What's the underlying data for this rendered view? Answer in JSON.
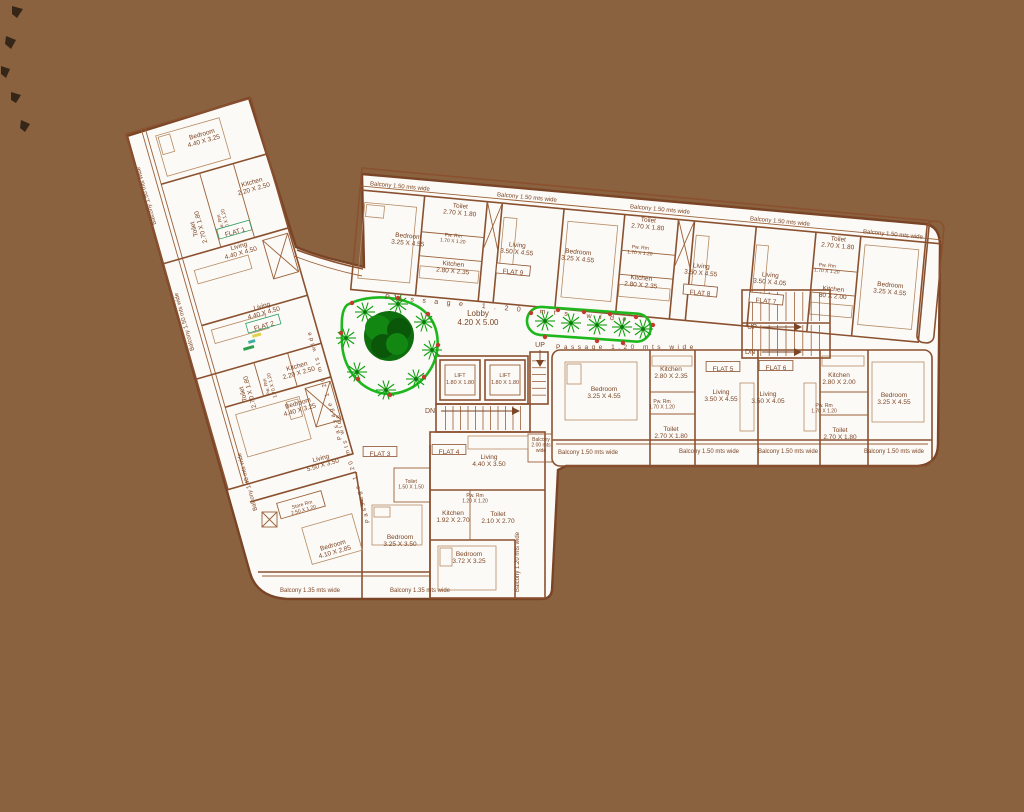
{
  "colors": {
    "background": "#8a6240",
    "plan_paper": "#fcfaf6",
    "wall_line": "#8a5130",
    "text": "#7c4526",
    "planter_green": "#1eb81e",
    "tree_dark_green": "#0c6e0c",
    "planter_dot_red": "#c23b2e",
    "flat_label_green": "#2d9e63"
  },
  "plan": {
    "lobby": {
      "name": "Lobby",
      "dims": "4.20 X 5.00"
    },
    "passage_label": "Passage 1.20 mts wide",
    "lift_label": "LIFT 1.80 X 1.80",
    "stairs": {
      "up": "UP",
      "down": "DN"
    },
    "flats": [
      "FLAT 1",
      "FLAT 2",
      "FLAT 3",
      "FLAT 4",
      "FLAT 5",
      "FLAT 6",
      "FLAT 7",
      "FLAT 8",
      "FLAT 9"
    ],
    "icons": [
      "palm-tree-icon",
      "shade-tree-icon",
      "staircase-icon",
      "planter-bed-icon"
    ]
  },
  "labels": [
    {
      "id": "wing-balcony-1",
      "c": "balc",
      "x": 146,
      "y": 196,
      "r": -106,
      "t": [
        "Balcony 1.50 mts wide"
      ]
    },
    {
      "id": "wing-balcony-2",
      "c": "balc",
      "x": 184,
      "y": 322,
      "r": -106,
      "t": [
        "Balcony 1.50 mts wide"
      ]
    },
    {
      "id": "bedroom-f1",
      "x": 203,
      "y": 138,
      "r": -16,
      "t": [
        "Bedroom",
        "4.40 X 3.25"
      ]
    },
    {
      "id": "toilet-f1",
      "x": 198,
      "y": 228,
      "r": -106,
      "t": [
        "Toilet",
        "2.70 X 1.80"
      ]
    },
    {
      "id": "pwrm-f1",
      "c": "tiny",
      "x": 224,
      "y": 222,
      "r": -106,
      "t": [
        "Pw. Rm",
        "1.70 X 1.20"
      ]
    },
    {
      "id": "kitchen-f1",
      "x": 253,
      "y": 186,
      "r": -16,
      "t": [
        "Kitchen",
        "2.20 X 2.50"
      ]
    },
    {
      "id": "flat1",
      "c": "flatg",
      "x": 235,
      "y": 232,
      "r": -16,
      "t": [
        "FLAT 1"
      ]
    },
    {
      "id": "living-f1",
      "x": 240,
      "y": 250,
      "r": -16,
      "t": [
        "Living",
        "4.40 X 4.50"
      ]
    },
    {
      "id": "living-f2",
      "x": 263,
      "y": 310,
      "r": -16,
      "t": [
        "Living",
        "4.40 X 4.50"
      ]
    },
    {
      "id": "flat2",
      "c": "flatg",
      "x": 264,
      "y": 326,
      "r": -16,
      "t": [
        "FLAT 2"
      ]
    },
    {
      "id": "toilet-f2",
      "x": 247,
      "y": 393,
      "r": -106,
      "t": [
        "Toilet",
        "2.70 X 1.80"
      ]
    },
    {
      "id": "pwrm-f2",
      "c": "tiny",
      "x": 270,
      "y": 386,
      "r": -106,
      "t": [
        "Pw. Rm",
        "1.70 X 1.20"
      ]
    },
    {
      "id": "kitchen-f2",
      "x": 298,
      "y": 370,
      "r": -16,
      "t": [
        "Kitchen",
        "2.20 X 2.50"
      ]
    },
    {
      "id": "bedroom-f2",
      "x": 299,
      "y": 407,
      "r": -16,
      "t": [
        "Bedroom",
        "4.40 X 3.25"
      ]
    },
    {
      "id": "living-f3",
      "x": 322,
      "y": 462,
      "r": -16,
      "t": [
        "Living",
        "5.50 X 3.50"
      ]
    },
    {
      "id": "flat3",
      "c": "flat",
      "x": 380,
      "y": 454,
      "t": [
        "FLAT 3"
      ]
    },
    {
      "id": "store-rm",
      "c": "tiny",
      "x": 303,
      "y": 508,
      "r": -16,
      "t": [
        "Store Rm",
        "2.50 X 1.20"
      ]
    },
    {
      "id": "bedroom-f3a",
      "x": 334,
      "y": 549,
      "r": -16,
      "t": [
        "Bedroom",
        "4.10 X 2.85"
      ]
    },
    {
      "id": "bedroom-f3b",
      "x": 400,
      "y": 541,
      "t": [
        "Bedroom",
        "3.25 X 3.50"
      ]
    },
    {
      "id": "balcony-left-low",
      "c": "balc",
      "x": 247,
      "y": 482,
      "r": -106,
      "t": [
        "Balcony 1.40 mts wide"
      ]
    },
    {
      "id": "balcony-bottom-1",
      "c": "balc",
      "x": 310,
      "y": 590,
      "t": [
        "Balcony 1.35 mts wide"
      ]
    },
    {
      "id": "balcony-bottom-2",
      "c": "balc",
      "x": 420,
      "y": 590,
      "t": [
        "Balcony 1.35 mts wide"
      ]
    },
    {
      "id": "toilet-small",
      "c": "tiny",
      "x": 411,
      "y": 485,
      "t": [
        "Toilet",
        "1.50 X 1.50"
      ]
    },
    {
      "id": "tb-balcony-1",
      "c": "balc",
      "x": 400,
      "y": 186,
      "r": 5.3,
      "t": [
        "Balcony 1.50 mts wide"
      ]
    },
    {
      "id": "tb-balcony-2",
      "c": "balc",
      "x": 527,
      "y": 197,
      "r": 5.3,
      "t": [
        "Balcony 1.50 mts wide"
      ]
    },
    {
      "id": "tb-balcony-3",
      "c": "balc",
      "x": 660,
      "y": 209,
      "r": 5.3,
      "t": [
        "Balcony 1.50 mts wide"
      ]
    },
    {
      "id": "tb-balcony-4",
      "c": "balc",
      "x": 780,
      "y": 221,
      "r": 5.3,
      "t": [
        "Balcony 1.50 mts wide"
      ]
    },
    {
      "id": "tb-balcony-5",
      "c": "balc",
      "x": 893,
      "y": 234,
      "r": 5.3,
      "t": [
        "Balcony 1.50 mts wide"
      ]
    },
    {
      "id": "bedroom-f9",
      "x": 408,
      "y": 240,
      "r": 5.3,
      "t": [
        "Bedroom",
        "3.25 X 4.55"
      ]
    },
    {
      "id": "toilet-f9",
      "x": 460,
      "y": 210,
      "r": 5.3,
      "t": [
        "Toilet",
        "2.70 X 1.80"
      ]
    },
    {
      "id": "pwrm-f9",
      "c": "tiny",
      "x": 453,
      "y": 239,
      "r": 5.3,
      "t": [
        "Pw. Rm",
        "1.70 X 1.20"
      ]
    },
    {
      "id": "kitchen-f9",
      "x": 453,
      "y": 268,
      "r": 5.3,
      "t": [
        "Kitchen",
        "2.80 X 2.35"
      ]
    },
    {
      "id": "living-f9",
      "x": 517,
      "y": 249,
      "r": 5.3,
      "t": [
        "Living",
        "3.50 X 4.55"
      ]
    },
    {
      "id": "flat9",
      "c": "flat",
      "x": 513,
      "y": 272,
      "r": 5.3,
      "t": [
        "FLAT 9"
      ]
    },
    {
      "id": "bedroom-f8",
      "x": 578,
      "y": 256,
      "r": 5.3,
      "t": [
        "Bedroom",
        "3.25 X 4.55"
      ]
    },
    {
      "id": "toilet-f8",
      "x": 648,
      "y": 224,
      "r": 5.3,
      "t": [
        "Toilet",
        "2.70 X 1.80"
      ]
    },
    {
      "id": "pwrm-f8",
      "c": "tiny",
      "x": 640,
      "y": 251,
      "r": 5.3,
      "t": [
        "Pw. Rm",
        "1.70 X 1.20"
      ]
    },
    {
      "id": "kitchen-f8",
      "x": 641,
      "y": 282,
      "r": 5.3,
      "t": [
        "Kitchen",
        "2.80 X 2.35"
      ]
    },
    {
      "id": "living-f8",
      "x": 701,
      "y": 270,
      "r": 5.3,
      "t": [
        "Living",
        "3.50 X 4.55"
      ]
    },
    {
      "id": "flat8",
      "c": "flat",
      "x": 700,
      "y": 293,
      "r": 5.3,
      "t": [
        "FLAT 8"
      ]
    },
    {
      "id": "living-f7",
      "x": 770,
      "y": 279,
      "r": 5.3,
      "t": [
        "Living",
        "3.50 X 4.05"
      ]
    },
    {
      "id": "flat7",
      "c": "flat",
      "x": 766,
      "y": 301,
      "r": 5.3,
      "t": [
        "FLAT 7"
      ]
    },
    {
      "id": "toilet-f7",
      "x": 838,
      "y": 243,
      "r": 5.3,
      "t": [
        "Toilet",
        "2.70 X 1.80"
      ]
    },
    {
      "id": "pwrm-f7",
      "c": "tiny",
      "x": 827,
      "y": 269,
      "r": 5.3,
      "t": [
        "Pw. Rm",
        "1.70 X 1.20"
      ]
    },
    {
      "id": "kitchen-f7",
      "x": 833,
      "y": 293,
      "r": 5.3,
      "t": [
        "Kitchen",
        "80 X 2.00"
      ]
    },
    {
      "id": "bedroom-f7",
      "x": 890,
      "y": 289,
      "r": 5.3,
      "t": [
        "Bedroom",
        "3.25 X 4.55"
      ]
    },
    {
      "id": "bedroom-f5",
      "x": 604,
      "y": 393,
      "t": [
        "Bedroom",
        "3.25 X 4.55"
      ]
    },
    {
      "id": "kitchen-f5",
      "x": 671,
      "y": 373,
      "t": [
        "Kitchen",
        "2.80 X 2.35"
      ]
    },
    {
      "id": "pwrm-f5",
      "c": "tiny",
      "x": 662,
      "y": 405,
      "t": [
        "Pw. Rm",
        "1.70 X 1.20"
      ]
    },
    {
      "id": "toilet-f5",
      "x": 671,
      "y": 433,
      "t": [
        "Toilet",
        "2.70 X 1.80"
      ]
    },
    {
      "id": "flat5",
      "c": "flat",
      "x": 723,
      "y": 369,
      "t": [
        "FLAT 5"
      ]
    },
    {
      "id": "living-f5",
      "x": 721,
      "y": 396,
      "t": [
        "Living",
        "3.50 X 4.55"
      ]
    },
    {
      "id": "flat6",
      "c": "flat",
      "x": 776,
      "y": 368,
      "t": [
        "FLAT 6"
      ]
    },
    {
      "id": "living-f6",
      "x": 768,
      "y": 398,
      "t": [
        "Living",
        "3.50 X 4.05"
      ]
    },
    {
      "id": "kitchen-f6",
      "x": 839,
      "y": 379,
      "t": [
        "Kitchen",
        "2.80 X 2.00"
      ]
    },
    {
      "id": "pwrm-f6",
      "c": "tiny",
      "x": 824,
      "y": 409,
      "t": [
        "Pw. Rm",
        "1.70 X 1.20"
      ]
    },
    {
      "id": "toilet-f6",
      "x": 840,
      "y": 434,
      "t": [
        "Toilet",
        "2.70 X 1.80"
      ]
    },
    {
      "id": "bedroom-f6",
      "x": 894,
      "y": 399,
      "t": [
        "Bedroom",
        "3.25 X 4.55"
      ]
    },
    {
      "id": "mr-balcony-1",
      "c": "balc",
      "x": 588,
      "y": 452,
      "t": [
        "Balcony 1.50 mts wide"
      ]
    },
    {
      "id": "mr-balcony-2",
      "c": "balc",
      "x": 709,
      "y": 451,
      "t": [
        "Balcony 1.50 mts wide"
      ]
    },
    {
      "id": "mr-balcony-3",
      "c": "balc",
      "x": 788,
      "y": 451,
      "t": [
        "Balcony 1.50 mts wide"
      ]
    },
    {
      "id": "mr-balcony-4",
      "c": "balc",
      "x": 894,
      "y": 451,
      "t": [
        "Balcony 1.50 mts wide"
      ]
    },
    {
      "id": "lobby",
      "c": "lobby",
      "x": 478,
      "y": 318,
      "t": [
        "Lobby",
        "4.20 X 5.00"
      ]
    },
    {
      "id": "lift-1",
      "c": "lift",
      "x": 460,
      "y": 379,
      "t": [
        "LIFT",
        "1.80 X 1.80"
      ]
    },
    {
      "id": "lift-2",
      "c": "lift",
      "x": 505,
      "y": 379,
      "t": [
        "LIFT",
        "1.80 X 1.80"
      ]
    },
    {
      "id": "up-lobby",
      "c": "updn",
      "x": 540,
      "y": 345,
      "t": [
        "UP"
      ]
    },
    {
      "id": "dn-lobby",
      "c": "updn",
      "x": 430,
      "y": 411,
      "t": [
        "DN"
      ]
    },
    {
      "id": "up-right",
      "c": "updn",
      "x": 752,
      "y": 327,
      "t": [
        "UP"
      ]
    },
    {
      "id": "dn-right",
      "c": "updn",
      "x": 750,
      "y": 352,
      "t": [
        "DN"
      ]
    },
    {
      "id": "flat4",
      "c": "flat",
      "x": 449,
      "y": 452,
      "t": [
        "FLAT 4"
      ]
    },
    {
      "id": "living-f4",
      "x": 489,
      "y": 461,
      "t": [
        "Living",
        "4.40 X 3.50"
      ]
    },
    {
      "id": "kitchen-f4",
      "x": 453,
      "y": 517,
      "t": [
        "Kitchen",
        "1.92 X 2.70"
      ]
    },
    {
      "id": "pwrm-f4",
      "c": "tiny",
      "x": 475,
      "y": 499,
      "t": [
        "Pw. Rm",
        "1.20 X 1.20"
      ]
    },
    {
      "id": "toilet-f4",
      "x": 498,
      "y": 518,
      "t": [
        "Toilet",
        "2.10 X 2.70"
      ]
    },
    {
      "id": "bedroom-f4",
      "x": 469,
      "y": 558,
      "t": [
        "Bedroom",
        "3.72 X 3.25"
      ]
    },
    {
      "id": "balcony-f4-right",
      "c": "balc",
      "x": 517,
      "y": 562,
      "r": -90,
      "t": [
        "Balcony 1.20 mts wide"
      ]
    },
    {
      "id": "balcony-f4-small",
      "c": "tiny",
      "x": 541,
      "y": 446,
      "t": [
        "Balcony",
        "2.00 mts",
        "wide"
      ]
    },
    {
      "id": "passage-top",
      "c": "pass1",
      "x": 385,
      "y": 297,
      "r": 5.3,
      "t": [
        "Passage 1.20 mts wide"
      ]
    },
    {
      "id": "passage-mid",
      "c": "pass2",
      "x": 556,
      "y": 347,
      "t": [
        "Passage 1.20 mts wide"
      ]
    },
    {
      "id": "passage-wing-1",
      "c": "passw",
      "x": 324,
      "y": 385,
      "r": -106,
      "t": [
        "Passage 1.20 mts wide"
      ]
    },
    {
      "id": "passage-wing-2",
      "c": "passw",
      "x": 352,
      "y": 468,
      "r": -106,
      "t": [
        "Passage 1.20 mts wide"
      ]
    }
  ]
}
